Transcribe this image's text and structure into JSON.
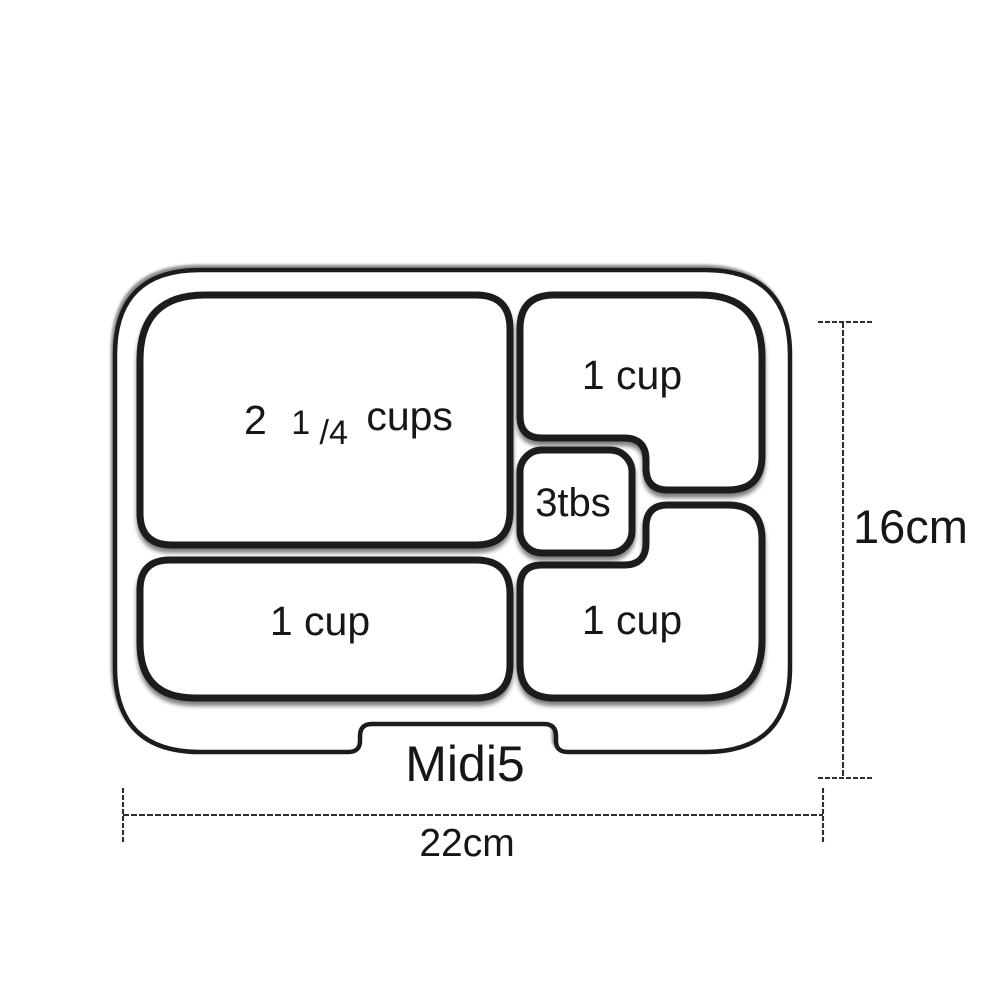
{
  "diagram": {
    "product_name": "Midi5",
    "compartments": {
      "large": {
        "label_whole": "2",
        "label_frac_num": "1",
        "label_frac_den": "/4",
        "label_unit": "cups",
        "full_label": "2 1/4 cups"
      },
      "top_right": {
        "label": "1 cup"
      },
      "center_small": {
        "label": "3tbs"
      },
      "bottom_left": {
        "label": "1 cup"
      },
      "bottom_right": {
        "label": "1 cup"
      }
    },
    "dimensions": {
      "height_label": "16cm",
      "width_label": "22cm"
    },
    "colors": {
      "outline": "#1b1b1b",
      "background": "#ffffff",
      "dimension_line": "#2e2e2e",
      "text": "#161616"
    }
  }
}
